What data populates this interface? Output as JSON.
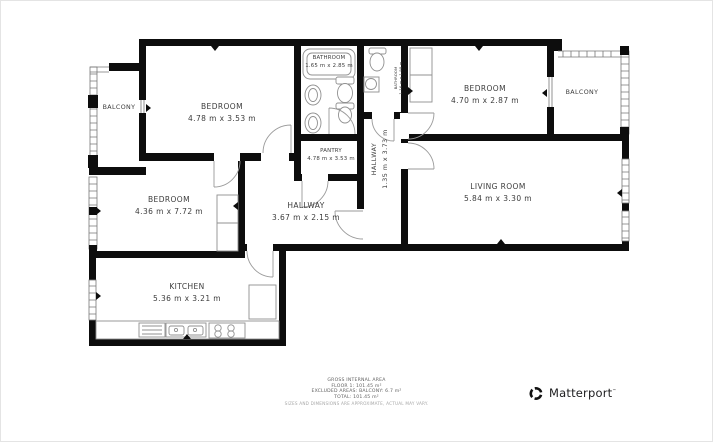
{
  "floorplan": {
    "rooms": [
      {
        "id": "balcony-left",
        "name": "BALCONY",
        "dims": ""
      },
      {
        "id": "bedroom-1",
        "name": "BEDROOM",
        "dims": "4.78 m x 3.53 m"
      },
      {
        "id": "bathroom-1",
        "name": "BATHROOM",
        "dims": "1.65 m x 2.85 m"
      },
      {
        "id": "bathroom-2",
        "name": "BATHROOM",
        "dims": "1.16 m x 1.98 m"
      },
      {
        "id": "hallway-upper",
        "name": "HALLWAY",
        "dims": "1.35 m x 3.73 m"
      },
      {
        "id": "bedroom-2",
        "name": "BEDROOM",
        "dims": "4.70 m x 2.87 m"
      },
      {
        "id": "balcony-right",
        "name": "BALCONY",
        "dims": ""
      },
      {
        "id": "pantry",
        "name": "PANTRY",
        "dims": "4.78 m x 3.53 m"
      },
      {
        "id": "living-room",
        "name": "LIVING ROOM",
        "dims": "5.84 m x 3.30 m"
      },
      {
        "id": "bedroom-3",
        "name": "BEDROOM",
        "dims": "4.36 m x 7.72 m"
      },
      {
        "id": "hallway-main",
        "name": "HALLWAY",
        "dims": "3.67 m x 2.15 m"
      },
      {
        "id": "kitchen",
        "name": "KITCHEN",
        "dims": "5.36 m x 3.21 m"
      }
    ],
    "footer": {
      "title": "GROSS INTERNAL AREA",
      "floor_line": "FLOOR 1: 101.45 m²",
      "excluded_line": "EXCLUDED AREAS: BALCONY: 6.7 m²",
      "total_line": "TOTAL: 101.45 m²",
      "disclaimer": "SIZES AND DIMENSIONS ARE APPROXIMATE, ACTUAL MAY VARY."
    },
    "brand": {
      "logo_text": "Matterport",
      "trademark": "™"
    },
    "colors": {
      "wall": "#0d0d0d",
      "label": "#3c3c3c",
      "fixture": "#909090",
      "door": "#9a9a9a",
      "window": "#787878",
      "footer-text": "#5f5f5f",
      "disclaimer": "#a8a8a8",
      "brand-text": "#1d1d1f"
    }
  }
}
